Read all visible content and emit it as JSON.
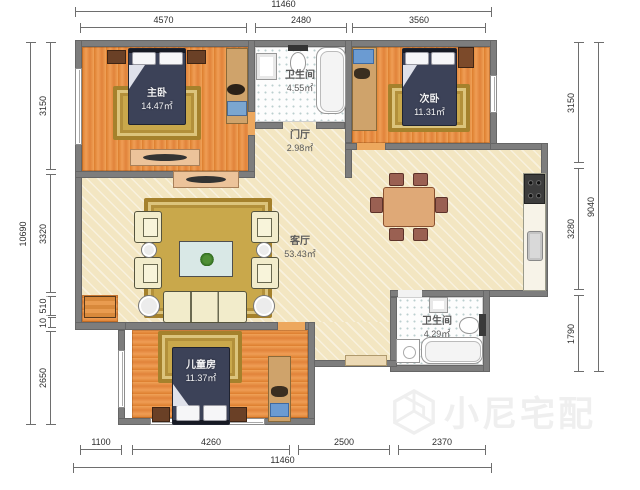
{
  "rooms": {
    "master": {
      "name": "主卧",
      "area": "14.47㎡"
    },
    "bath_top": {
      "name": "卫生间",
      "area": "4.55㎡"
    },
    "second": {
      "name": "次卧",
      "area": "11.31㎡"
    },
    "foyer": {
      "name": "门厅",
      "area": "2.98㎡"
    },
    "living": {
      "name": "客厅",
      "area": "53.43㎡"
    },
    "bath_bottom": {
      "name": "卫生间",
      "area": "4.29㎡"
    },
    "kids": {
      "name": "儿童房",
      "area": "11.37㎡"
    }
  },
  "dimensions": {
    "top": {
      "overall": "11460",
      "segments": [
        "4570",
        "2480",
        "3560"
      ]
    },
    "bottom": {
      "overall": "11460",
      "segments": [
        "1100",
        "4260",
        "2500",
        "2370"
      ]
    },
    "left": {
      "overall": "10690",
      "segments": [
        "3150",
        "3320",
        "510",
        "10",
        "2650"
      ]
    },
    "right": {
      "overall": "9040",
      "segments": [
        "3150",
        "3280",
        "1790"
      ]
    }
  },
  "watermark": {
    "text": "小尼宅配"
  },
  "colors": {
    "wall": "#7d7d7d",
    "wood_floor": "#e78b3c",
    "living_floor": "#f3e6c2",
    "bed": "#3c4258",
    "rug": "#c9a84b",
    "watermark": "#efefef"
  }
}
